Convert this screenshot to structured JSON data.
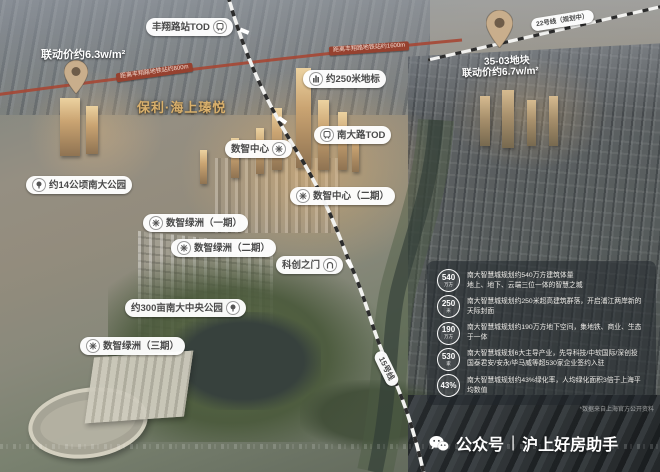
{
  "labels": {
    "fengxiang_tod": "丰翔路站TOD",
    "price_63": "联动价约6.3w/m²",
    "dist_800": "距离丰翔路地铁站约800m",
    "project_name": "保利·海上瑧悦",
    "line22": "22号线（规划中）",
    "dist_1600": "距离丰翔路地铁站约1600m",
    "plot_3503": "35-03地块",
    "price_67": "联动价约6.7w/m²",
    "landmark_250": "约250米地标",
    "nandalu_tod": "南大路TOD",
    "shuzhi_center_1": "数智中心",
    "shuzhi_center_2": "数智中心（二期）",
    "nanda_park_14": "约14公顷南大公园",
    "oasis_1": "数智绿洲（一期）",
    "oasis_2": "数智绿洲（二期）",
    "kechuang_gate": "科创之门",
    "central_park_300": "约300亩南大中央公园",
    "oasis_3": "数智绿洲（三期）",
    "line15": "15号线"
  },
  "stats_panel": {
    "rows": [
      {
        "value": "540",
        "unit": "万方",
        "line1": "南大智慧城规划约540万方建筑体量",
        "line2": "地上、地下、云端三位一体的智慧之城"
      },
      {
        "value": "250",
        "unit": "米",
        "line1": "南大智慧城规划约250米超高建筑群落，开启浦江两岸新的天际封面"
      },
      {
        "value": "190",
        "unit": "万方",
        "line1": "南大智慧城规划约190万方地下空间，集地铁、商业、生态于一体"
      },
      {
        "value": "530",
        "unit": "家",
        "line1": "南大智慧城规划6大主导产业，先导科技/中软国际/深创投",
        "line2": "国泰君安/安永/毕马威等超530家企业签约入驻"
      },
      {
        "value": "43%",
        "unit": "",
        "line1": "南大智慧城规划约43%绿化率，人均绿化面积3倍于上海平均数值"
      }
    ]
  },
  "footer": {
    "wechat_label": "公众号",
    "divider": "|",
    "account_name": "沪上好房助手",
    "footnote": "*数据来自上海官方公开资料"
  },
  "colors": {
    "badge_red": "#96412f",
    "gold_text": "#d9b06c",
    "panel_bg": "rgba(33,38,43,0.55)",
    "metro_line_white": "#f2f2f0",
    "metro_line_black": "#2c2c2c",
    "highway_red": "#a64734"
  }
}
